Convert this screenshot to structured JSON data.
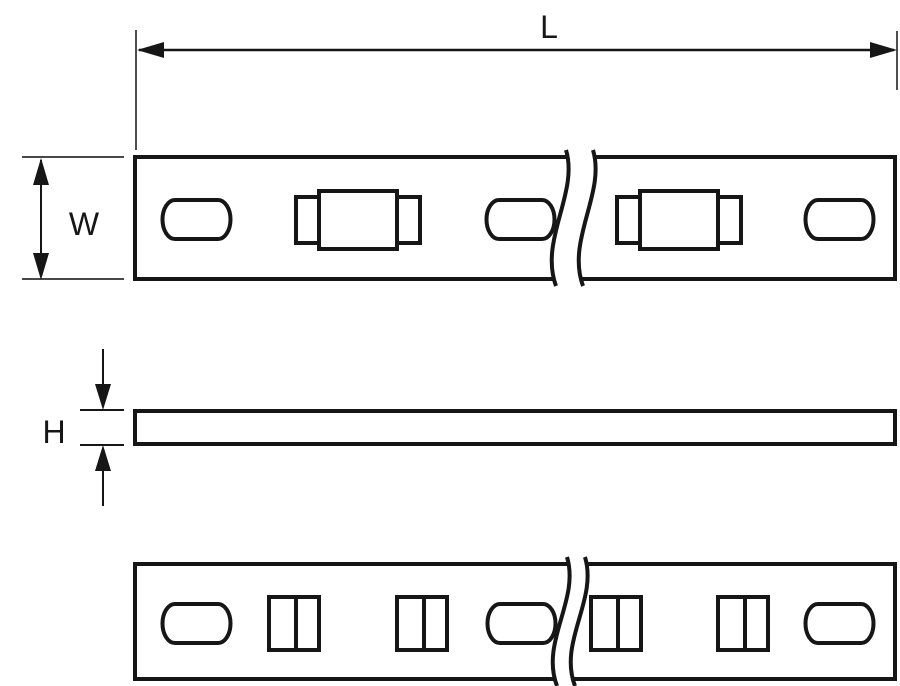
{
  "page": {
    "background_color": "#ffffff"
  },
  "drawing": {
    "line_color": "#161616",
    "labels": {
      "length": "L",
      "width": "W",
      "height": "H"
    }
  }
}
